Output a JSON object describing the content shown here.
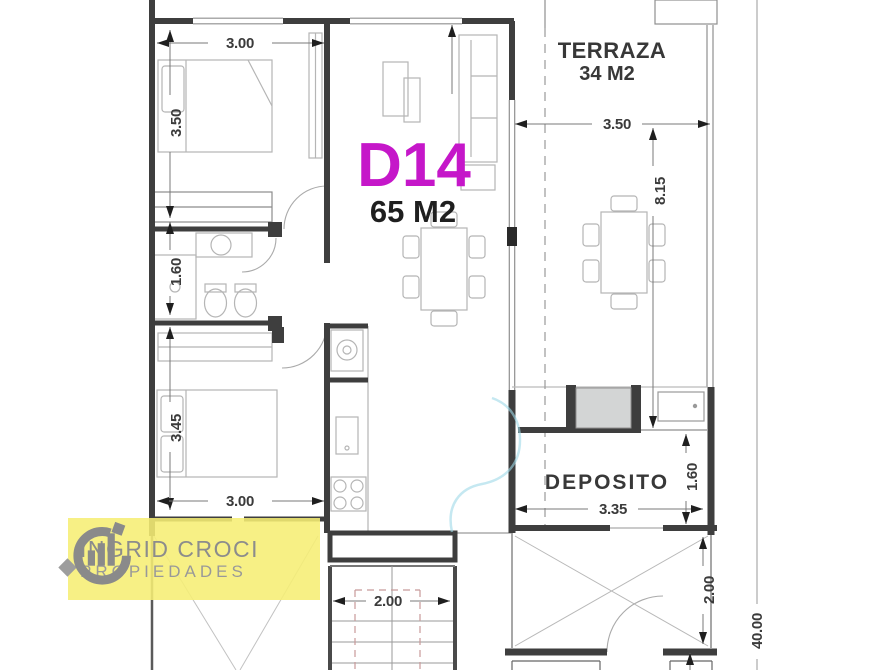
{
  "plan": {
    "unit": {
      "label": "D14",
      "area": "65 M2",
      "label_color": "#c517c9"
    },
    "terraza": {
      "label": "TERRAZA",
      "area": "34 M2"
    },
    "deposito": {
      "label": "DEPOSITO"
    },
    "dimensions": {
      "bedroom1_width": "3.00",
      "bedroom1_depth": "3.50",
      "bathroom_depth": "1.60",
      "bedroom2_depth": "3.45",
      "bedroom2_width": "3.00",
      "terraza_width": "3.50",
      "terraza_length": "8.15",
      "deposito_width": "3.35",
      "deposito_depth": "1.60",
      "stairs_width": "2.00",
      "void_depth": "2.00",
      "lot_length": "40.00"
    },
    "colors": {
      "wall": "#3e3e3e",
      "furniture_line": "#b5b5b5",
      "dimension_arrow": "#1f1f1f",
      "stair_guide": "#c89a9a",
      "watermark_blue": "#9fd8e8"
    }
  },
  "logo": {
    "line1": "INGRID CROCI",
    "line2": "PROPIEDADES",
    "background": "#f6ee74",
    "text_color": "#8c8c8c"
  }
}
